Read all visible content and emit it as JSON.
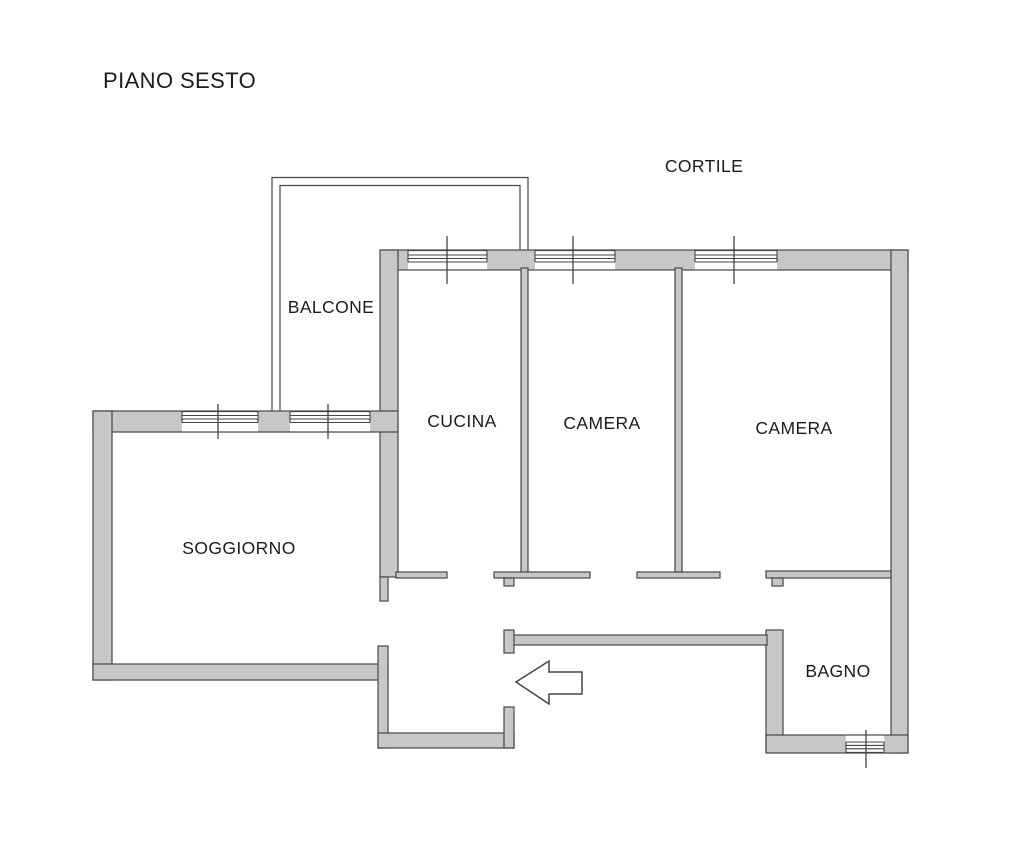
{
  "title": "PIANO SESTO",
  "plan": {
    "outdoor_label": "CORTILE",
    "rooms": {
      "balcone": {
        "label": "BALCONE"
      },
      "cucina": {
        "label": "CUCINA"
      },
      "camera1": {
        "label": "CAMERA"
      },
      "camera2": {
        "label": "CAMERA"
      },
      "soggiorno": {
        "label": "SOGGIORNO"
      },
      "bagno": {
        "label": "BAGNO"
      }
    },
    "icons": {
      "entry_arrow": "arrow-left-entrance"
    }
  },
  "colors": {
    "background": "#ffffff",
    "wall_fill": "#c7c7c7",
    "line": "#454545",
    "text": "#1c1c1c"
  }
}
